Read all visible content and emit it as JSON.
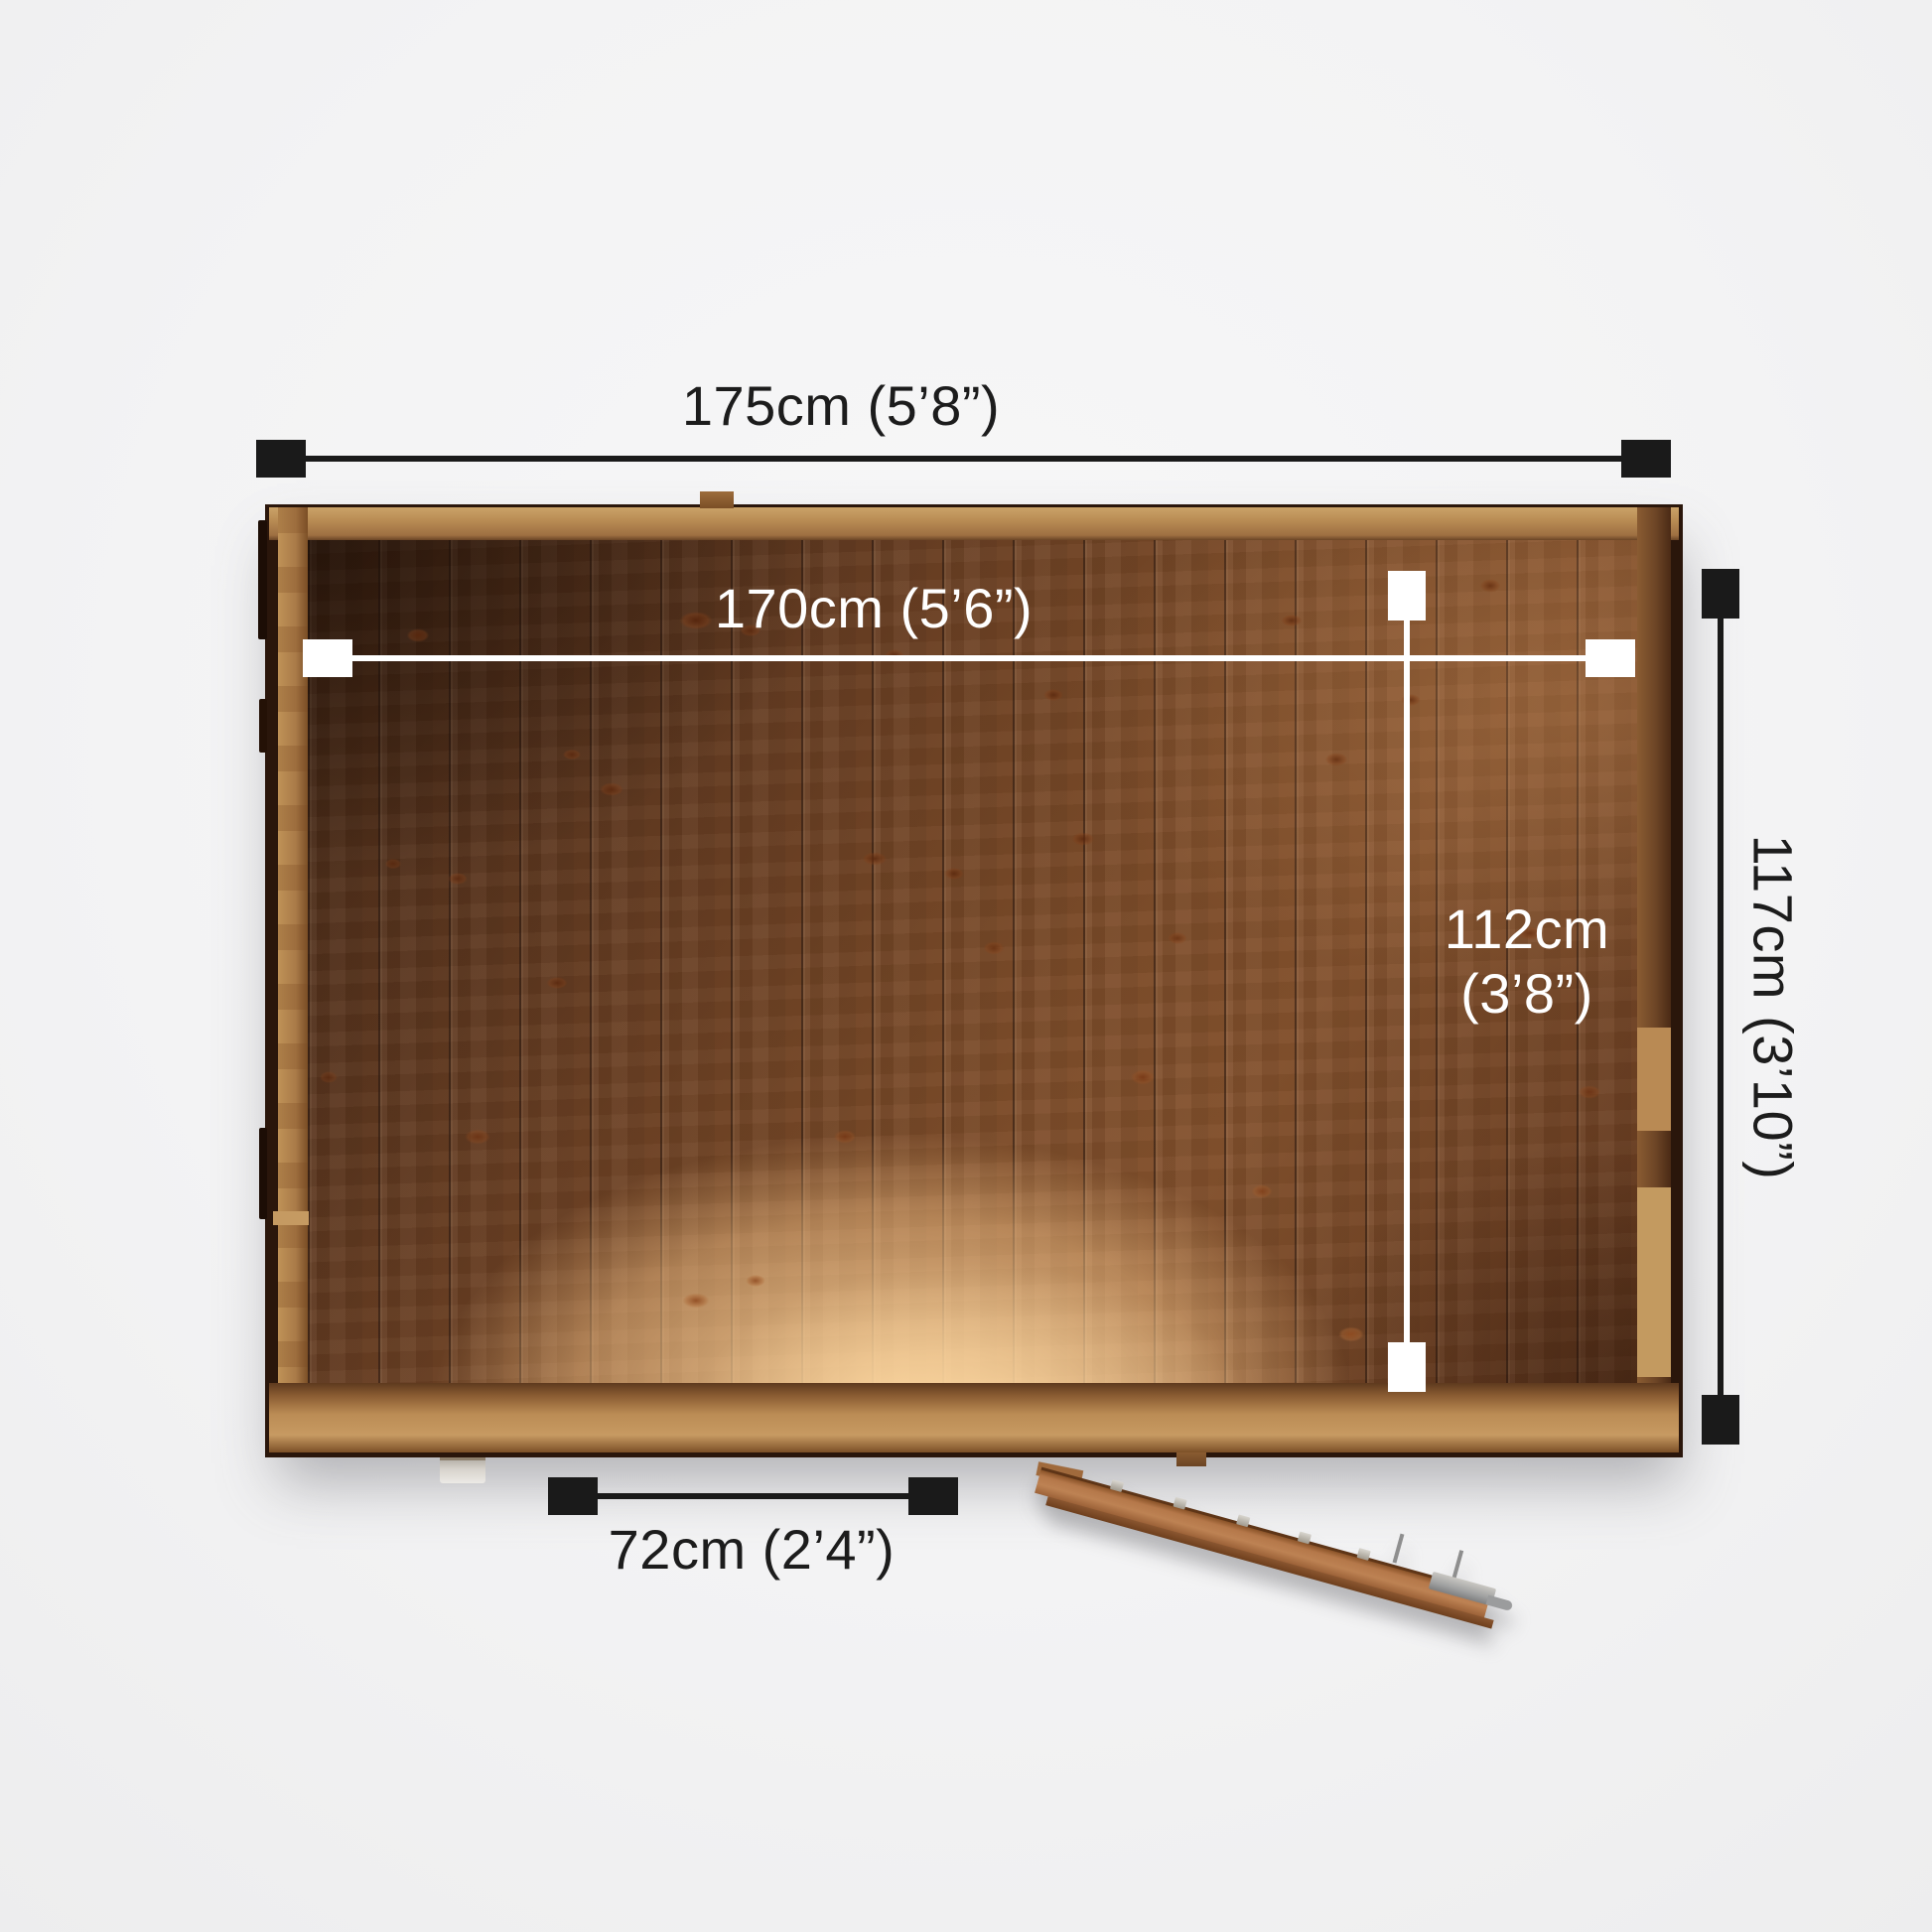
{
  "diagram": {
    "dimensions": {
      "overall_width": {
        "label": "175cm (5’8”)",
        "arrow_color": "#1a1a1a",
        "orientation": "horizontal",
        "position": "above shed"
      },
      "internal_width": {
        "label": "170cm (5’6”)",
        "arrow_color": "#ffffff",
        "orientation": "horizontal",
        "position": "inside shed, upper"
      },
      "internal_depth": {
        "label_line1": "112cm",
        "label_line2": "(3’8”)",
        "arrow_color": "#ffffff",
        "orientation": "vertical",
        "position": "inside shed, right"
      },
      "overall_depth": {
        "label": "117cm (3’10”)",
        "arrow_color": "#1a1a1a",
        "orientation": "vertical",
        "position": "right of shed, text rotated 90°"
      },
      "door_width": {
        "label": "72cm (2’4”)",
        "arrow_color": "#1a1a1a",
        "orientation": "horizontal",
        "position": "below shed, lower-left"
      }
    },
    "colors": {
      "background": "#f3f3f4",
      "arrow_dark": "#1a1a1a",
      "arrow_light": "#ffffff",
      "wood_panel_dark": "#4a2a17",
      "wood_panel_mid": "#7e4d2a",
      "wood_panel_light": "#d8a871",
      "wood_frame": "#b98c54",
      "shed_outline": "#2a160b",
      "metal_hardware": "#9fa0a0"
    }
  }
}
